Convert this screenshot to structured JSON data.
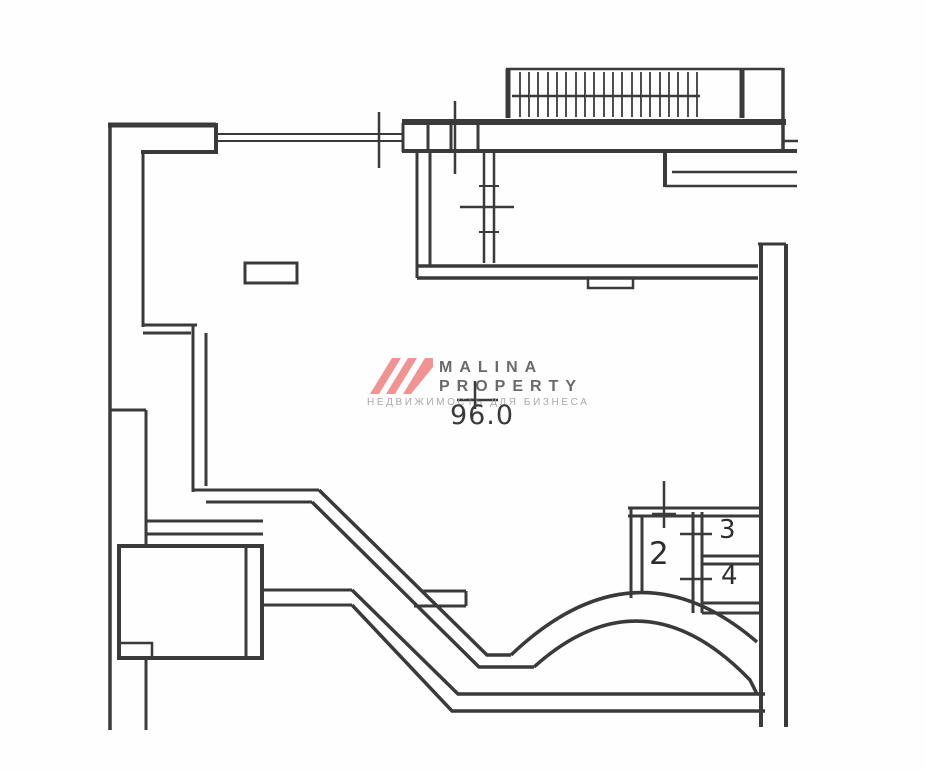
{
  "watermark": {
    "line1": "MALINA",
    "line2": "PROPERTY",
    "tagline": "НЕДВИЖИМОСТЬ ДЛЯ БИЗНЕСА",
    "logo_color": "#ef8b8b"
  },
  "plan": {
    "area_label": "96.0",
    "wall_color": "#3a3a3a",
    "rooms": [
      {
        "label": "2"
      },
      {
        "label": "3"
      },
      {
        "label": "4"
      }
    ]
  }
}
